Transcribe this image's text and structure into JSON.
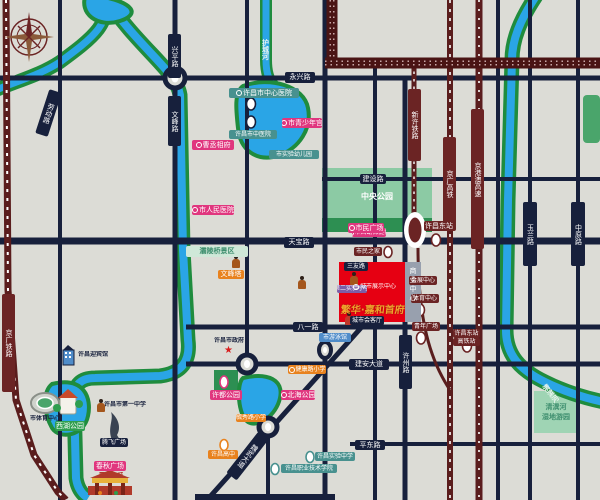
{
  "map_meta": {
    "type": "real-estate-location-map",
    "city_hint": "许昌",
    "colors": {
      "background": "#dcdcd6",
      "road": "#17203c",
      "water": "#2aa5e6",
      "water_edge": "#1f8c3e",
      "railway": "#5a1d1d",
      "project_red": "#e60012",
      "pink": "#e0367e",
      "teal": "#48918f",
      "orange": "#e8821e",
      "park": "#8ccaa4",
      "gold": "#f0a32c"
    }
  },
  "road_labels": [
    {
      "t": "兴平路"
    },
    {
      "t": "文峰路"
    },
    {
      "t": "劳动路"
    },
    {
      "t": "永兴路"
    },
    {
      "t": "天宝路"
    },
    {
      "t": "建设路"
    },
    {
      "t": "玉兰路"
    },
    {
      "t": "中原路"
    },
    {
      "t": "许州路"
    },
    {
      "t": "八一路"
    },
    {
      "t": "建安大道"
    },
    {
      "t": "平东路"
    },
    {
      "t": "魏武大道"
    },
    {
      "t": "三友路"
    }
  ],
  "rail_labels": [
    {
      "t": "京广铁路"
    },
    {
      "t": "京广高铁"
    },
    {
      "t": "京港澳高速"
    },
    {
      "t": "新许铁路"
    }
  ],
  "river_labels": [
    {
      "t": "护城河"
    },
    {
      "t": "清潩河"
    }
  ],
  "parks": {
    "central": {
      "label": "中央公园"
    },
    "qingyi": {
      "line1": "清潩河",
      "line2": "湿地游园"
    },
    "baling": {
      "label": "灞陵桥景区"
    },
    "xudu": {
      "label": "许都公园"
    },
    "xihu": {
      "label": "西湖公园"
    }
  },
  "transit": [
    {
      "t": "许昌东站"
    },
    {
      "t": "会展中心"
    },
    {
      "t": "体育中心"
    },
    {
      "t": "青年广场"
    },
    {
      "t": "市民之家"
    },
    {
      "t": "许昌东站",
      "t2": "高铁站"
    }
  ],
  "pois": [
    {
      "t": "许昌市中心医院"
    },
    {
      "t": "许昌市中医院"
    },
    {
      "t": "市实验幼儿园"
    },
    {
      "t": "许昌实验中学"
    },
    {
      "t": "许昌职业技术学院"
    },
    {
      "t": "市青少年宫"
    },
    {
      "t": "曹丞相府"
    },
    {
      "t": "市人民医院"
    },
    {
      "t": "春秋广场"
    },
    {
      "t": "市妇幼保健院"
    },
    {
      "t": "北海公园"
    },
    {
      "t": "市民广场"
    },
    {
      "t": "文峰塔"
    },
    {
      "t": "健康路小学"
    },
    {
      "t": "毓秀路小学"
    },
    {
      "t": "许昌高中"
    },
    {
      "t": "许昌市政府"
    },
    {
      "t": "许昌迎宾馆"
    },
    {
      "t": "许昌市第一中学"
    },
    {
      "t": "腾飞广场"
    },
    {
      "t": "市体育中心"
    },
    {
      "t": "城市会客厅"
    },
    {
      "t": "市游泳馆"
    },
    {
      "t": "第二实验小学"
    },
    {
      "t": "曹魏古城"
    }
  ],
  "project": {
    "name": "繁华·嘉和首府",
    "center_label": "城市展示中心",
    "strip_label": "商业中心"
  }
}
